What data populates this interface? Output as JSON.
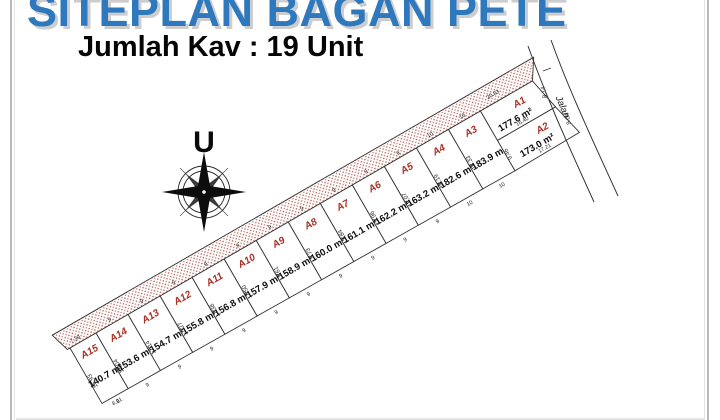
{
  "page": {
    "title": "SITEPLAN BAGAN PETE",
    "subtitle": "Jumlah Kav : 19 Unit"
  },
  "compass": {
    "label": "U"
  },
  "colors": {
    "title_blue": "#2e79be",
    "plot_id_red": "#a93226",
    "hatch_dot": "#b05a50",
    "line_dark": "#333333"
  },
  "plan": {
    "road_label": "Jalan",
    "hatch_length_label": "20.83",
    "plots": [
      {
        "id": "A1",
        "area": "177.6 m²",
        "labels": {
          "bottom": "16.40",
          "right": "8.14"
        }
      },
      {
        "id": "A2",
        "area": "173.0 m²",
        "labels": {
          "bottom": "17.21",
          "right": "9.04",
          "left": "9.46"
        }
      },
      {
        "id": "A3",
        "area": "183.9 m²",
        "labels": {
          "left": "18.33",
          "width_top": "10",
          "width_bottom": "10"
        }
      },
      {
        "id": "A4",
        "area": "182.6 m²",
        "labels": {
          "left": "18.19",
          "width_top": "10",
          "width_bottom": "10"
        }
      },
      {
        "id": "A5",
        "area": "163.2 m²",
        "labels": {
          "left": "18.07",
          "width_top": "9",
          "width_bottom": "9"
        }
      },
      {
        "id": "A6",
        "area": "162.2 m²",
        "labels": {
          "left": "17.96",
          "width_top": "9",
          "width_bottom": "9"
        }
      },
      {
        "id": "A7",
        "area": "161.1 m²",
        "labels": {
          "left": "17.84",
          "width_top": "9",
          "width_bottom": "9"
        }
      },
      {
        "id": "A8",
        "area": "160.0 m²",
        "labels": {
          "left": "17.73",
          "width_top": "9",
          "width_bottom": "9"
        }
      },
      {
        "id": "A9",
        "area": "158.9 m²",
        "labels": {
          "left": "17.61",
          "width_top": "9",
          "width_bottom": "9"
        }
      },
      {
        "id": "A10",
        "area": "157.9 m²",
        "labels": {
          "left": "17.50",
          "width_top": "9",
          "width_bottom": "9"
        }
      },
      {
        "id": "A11",
        "area": "156.8 m²",
        "labels": {
          "left": "17.38",
          "width_top": "9",
          "width_bottom": "9"
        }
      },
      {
        "id": "A12",
        "area": "155.8 m²",
        "labels": {
          "left": "17.27",
          "width_top": "9",
          "width_bottom": "9"
        }
      },
      {
        "id": "A13",
        "area": "154.7 m²",
        "labels": {
          "left": "17.14",
          "width_top": "9",
          "width_bottom": "9"
        }
      },
      {
        "id": "A14",
        "area": "153.6 m²",
        "labels": {
          "left": "17.04",
          "width_top": "9",
          "width_bottom": "9"
        }
      },
      {
        "id": "A15",
        "area": "140.7 m²",
        "labels": {
          "left": "16.93",
          "bottom": "8.21",
          "hatch_end": "7.39",
          "width_bottom": "9"
        }
      }
    ]
  }
}
